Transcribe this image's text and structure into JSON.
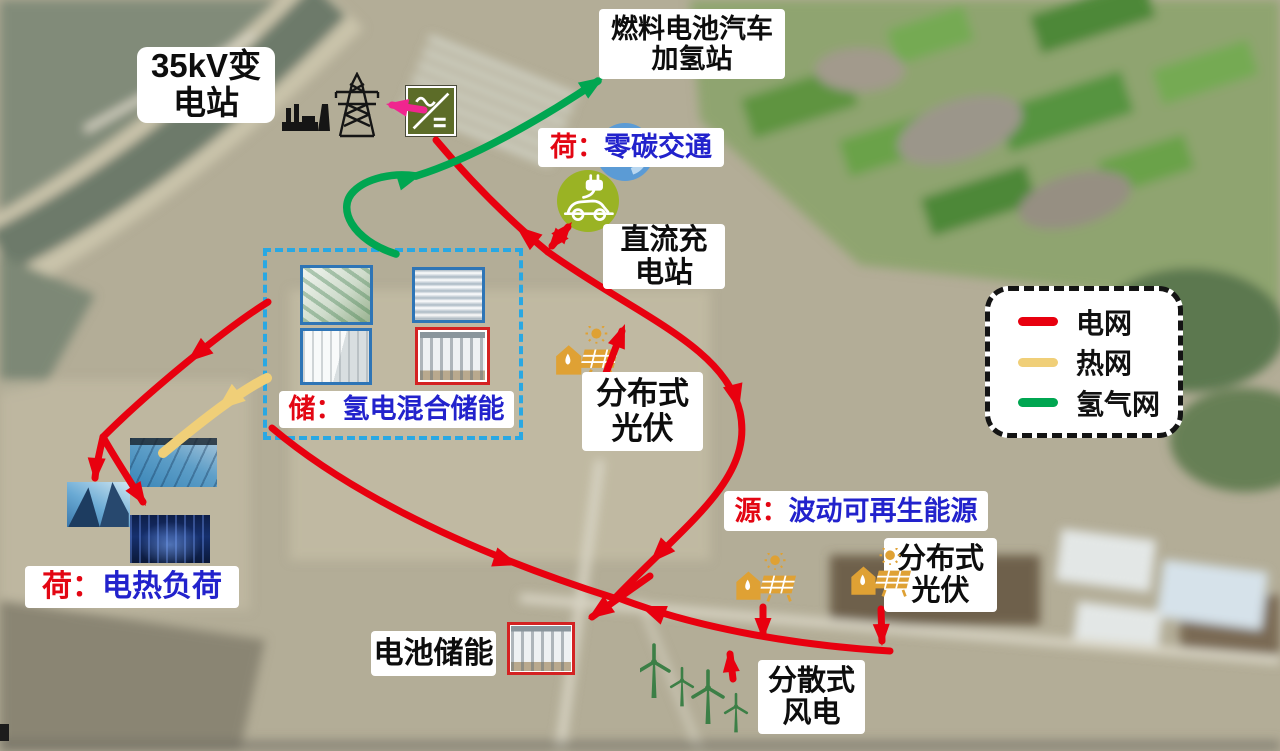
{
  "network_colors": {
    "grid": "#e8000f",
    "heat": "#f0cf78",
    "hydrogen": "#00a651",
    "converter_arrow": "#f0258f",
    "dashed_box": "#29a8e3"
  },
  "labels": {
    "substation": {
      "line1": "35kV变",
      "line2": "电站"
    },
    "h2_station": {
      "line1": "燃料电池汽车",
      "line2": "加氢站"
    },
    "h2_symbol": "H₂",
    "zero_carbon": {
      "prefix": "荷：",
      "text": "零碳交通"
    },
    "dc_charging": {
      "line1": "直流充",
      "line2": "电站"
    },
    "storage": {
      "prefix": "储：",
      "text": "氢电混合储能"
    },
    "pv_mid": {
      "line1": "分布式",
      "line2": "光伏"
    },
    "source": {
      "prefix": "源：",
      "text": "波动可再生能源"
    },
    "pv_right": {
      "line1": "分布式",
      "line2": "光伏"
    },
    "heat_load": {
      "prefix": "荷：",
      "text": "电热负荷"
    },
    "battery": "电池储能",
    "wind": {
      "line1": "分散式",
      "line2": "风电"
    }
  },
  "legend": {
    "items": [
      {
        "label": "电网",
        "color": "#e8000f"
      },
      {
        "label": "热网",
        "color": "#f0cf78"
      },
      {
        "label": "氢气网",
        "color": "#00a651"
      }
    ]
  }
}
